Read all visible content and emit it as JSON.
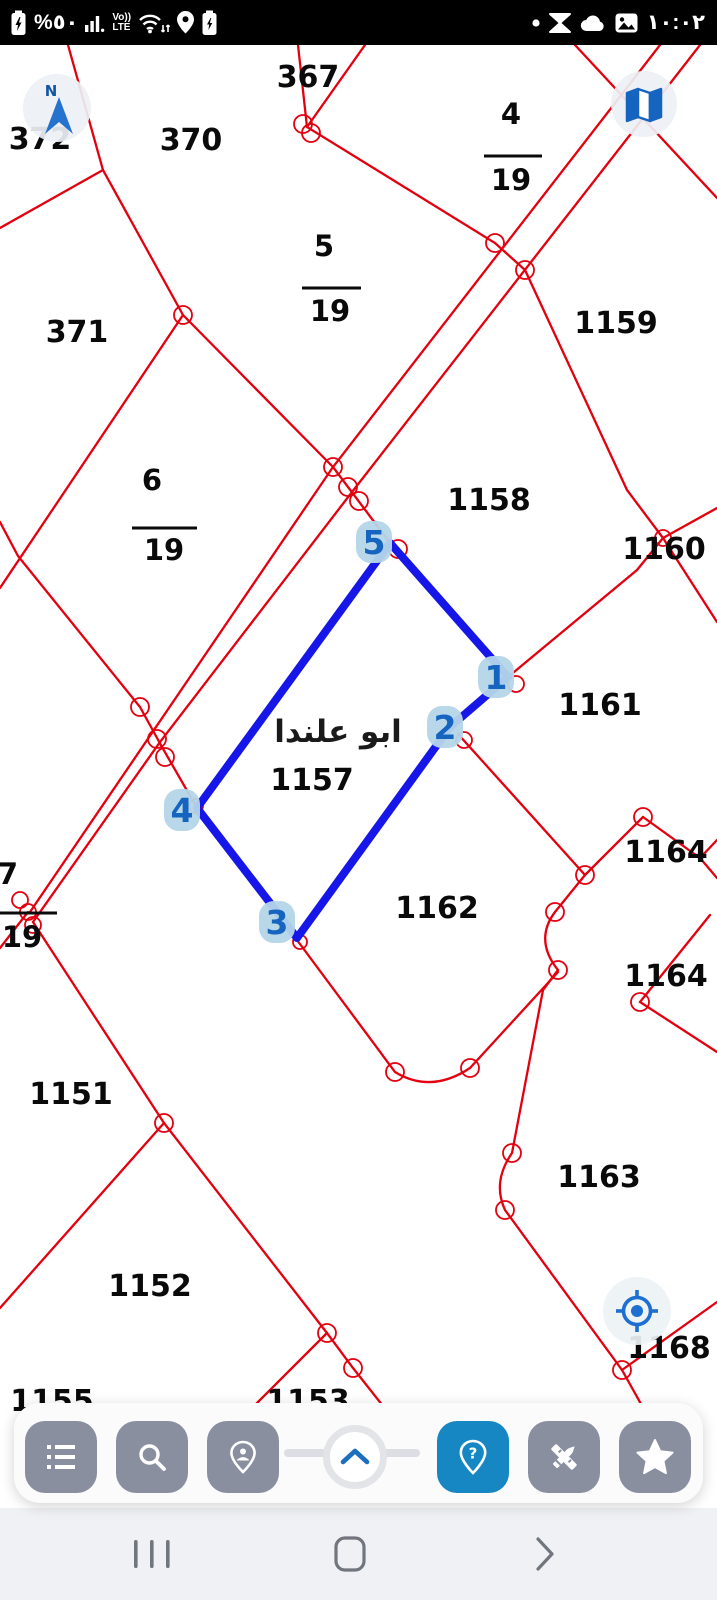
{
  "status_bar": {
    "time": "١٠:٠٢",
    "battery_percent": "%٥٠",
    "volte_line1": "Vo))",
    "volte_line2": "LTE",
    "left_icons": [
      "battery-charging",
      "battery-percent",
      "signal-strength",
      "volte",
      "wifi-updown",
      "location-pin",
      "battery-saver"
    ],
    "right_icons": [
      "notification-dot",
      "hourglass",
      "cloud",
      "gallery",
      "clock"
    ]
  },
  "map": {
    "background": "#ffffff",
    "boundary_color": "#e3000f",
    "selection_color": "#1616e8",
    "badge_bg": "#b4d6e9",
    "badge_text_color": "#1565c0",
    "place_label": "ابو علندا",
    "selected_parcel": "1157",
    "vertex_labels": [
      "1",
      "2",
      "3",
      "4",
      "5"
    ],
    "labels": [
      "372",
      "370",
      "367",
      "371",
      "1159",
      "1158",
      "1160",
      "1161",
      "1157",
      "1162",
      "1164",
      "1164",
      "1151",
      "1163",
      "1152",
      "1168",
      "1155",
      "1153"
    ],
    "fractions": [
      {
        "num": "4",
        "den": "19"
      },
      {
        "num": "5",
        "den": "19"
      },
      {
        "num": "6",
        "den": "19"
      },
      {
        "num": "7",
        "den": "19"
      }
    ]
  },
  "controls": {
    "compass_label": "N",
    "floating": [
      "compass",
      "map-layers",
      "my-location-target"
    ]
  },
  "toolbar": {
    "buttons": [
      {
        "name": "legend-list"
      },
      {
        "name": "search"
      },
      {
        "name": "locate-person"
      },
      {
        "name": "expand-handle"
      },
      {
        "name": "help-pin",
        "active": true
      },
      {
        "name": "measure-tools"
      },
      {
        "name": "favorites-star"
      }
    ]
  },
  "navigation_bar": {
    "icons": [
      "recents",
      "home",
      "back"
    ]
  }
}
